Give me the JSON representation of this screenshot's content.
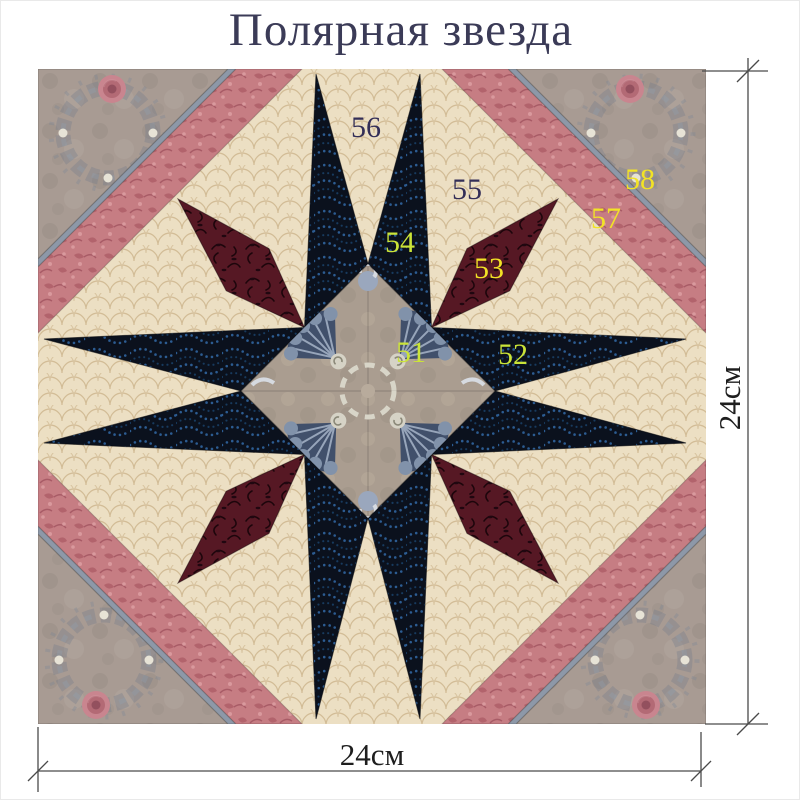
{
  "title": "Полярная звезда",
  "quilt": {
    "name": "polar-star-quilt-block",
    "pieces": [
      {
        "id": "51",
        "label": "51",
        "fabric": "center floral medallion",
        "label_color": "#cbe438"
      },
      {
        "id": "52",
        "label": "52",
        "fabric": "navy star spike (east)",
        "label_color": "#cbe438"
      },
      {
        "id": "53",
        "label": "53",
        "fabric": "burgundy star point",
        "label_color": "#f2e326"
      },
      {
        "id": "54",
        "label": "54",
        "fabric": "navy star spike (north)",
        "label_color": "#cbe438"
      },
      {
        "id": "55",
        "label": "55",
        "fabric": "cream background",
        "label_color": "#332e57"
      },
      {
        "id": "56",
        "label": "56",
        "fabric": "cream background wedge",
        "label_color": "#332e57"
      },
      {
        "id": "57",
        "label": "57",
        "fabric": "rose border strip",
        "label_color": "#f2e326"
      },
      {
        "id": "58",
        "label": "58",
        "fabric": "taupe floral corner",
        "label_color": "#f2e326"
      }
    ]
  },
  "dimensions": {
    "bottom": "24см",
    "right": "24см"
  },
  "colors": {
    "title_text": "#3b3b57",
    "cream_fabric": "#ecdfc3",
    "navy_fabric": "#0b111d",
    "burgundy_fabric": "#561824",
    "rose_strip_fabric": "#c67d83",
    "taupe_corner_fabric": "#a89b93",
    "piping": "#8d98a8",
    "center_floral_base": "#aa9d90",
    "label_green": "#cbe438",
    "label_yellow": "#f2e326",
    "label_dark": "#332e57",
    "dimension_lines": "#4a4a4a"
  }
}
